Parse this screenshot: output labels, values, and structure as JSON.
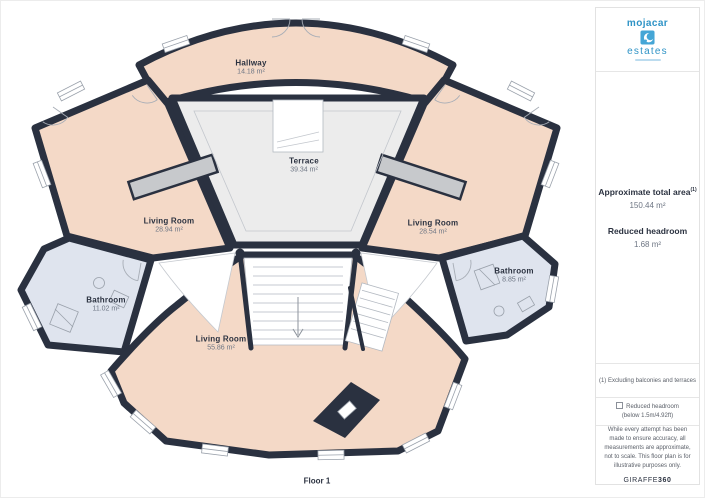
{
  "plan": {
    "floor_label": "Floor 1",
    "rooms": [
      {
        "name": "Hallway",
        "area": "14.18 m²"
      },
      {
        "name": "Terrace",
        "area": "39.34 m²"
      },
      {
        "name": "Living Room",
        "area": "28.94 m²"
      },
      {
        "name": "Living Room",
        "area": "28.54 m²"
      },
      {
        "name": "Living Room",
        "area": "55.86 m²"
      },
      {
        "name": "Bathroom",
        "area": "11.02 m²"
      },
      {
        "name": "Bathroom",
        "area": "8.85 m²"
      }
    ]
  },
  "sidebar": {
    "logo": {
      "line1": "mojacar",
      "line2": "estates"
    },
    "summary": [
      {
        "label": "Approximate total area",
        "sup": "(1)",
        "value": "150.44 m²"
      },
      {
        "label": "Reduced headroom",
        "sup": "",
        "value": "1.68 m²"
      }
    ],
    "footnotes": {
      "note1": "(1) Excluding balconies and terraces",
      "note2_title": "Reduced headroom",
      "note2_detail": "(below 1.5m/4.92ft)"
    },
    "disclaimer": "While every attempt has been made to ensure accuracy, all measurements are approximate, not to scale. This floor plan is for illustrative purposes only.",
    "brand": {
      "regular": "GIRAFFE",
      "bold": "360"
    }
  },
  "colors": {
    "wall": "#2a3140",
    "room_pink": "#f4d9c7",
    "terrace_gray": "#ececec",
    "bathroom_blue": "#dfe4ee",
    "logo_blue": "#2e93c6",
    "text_navy": "#2b3240"
  }
}
